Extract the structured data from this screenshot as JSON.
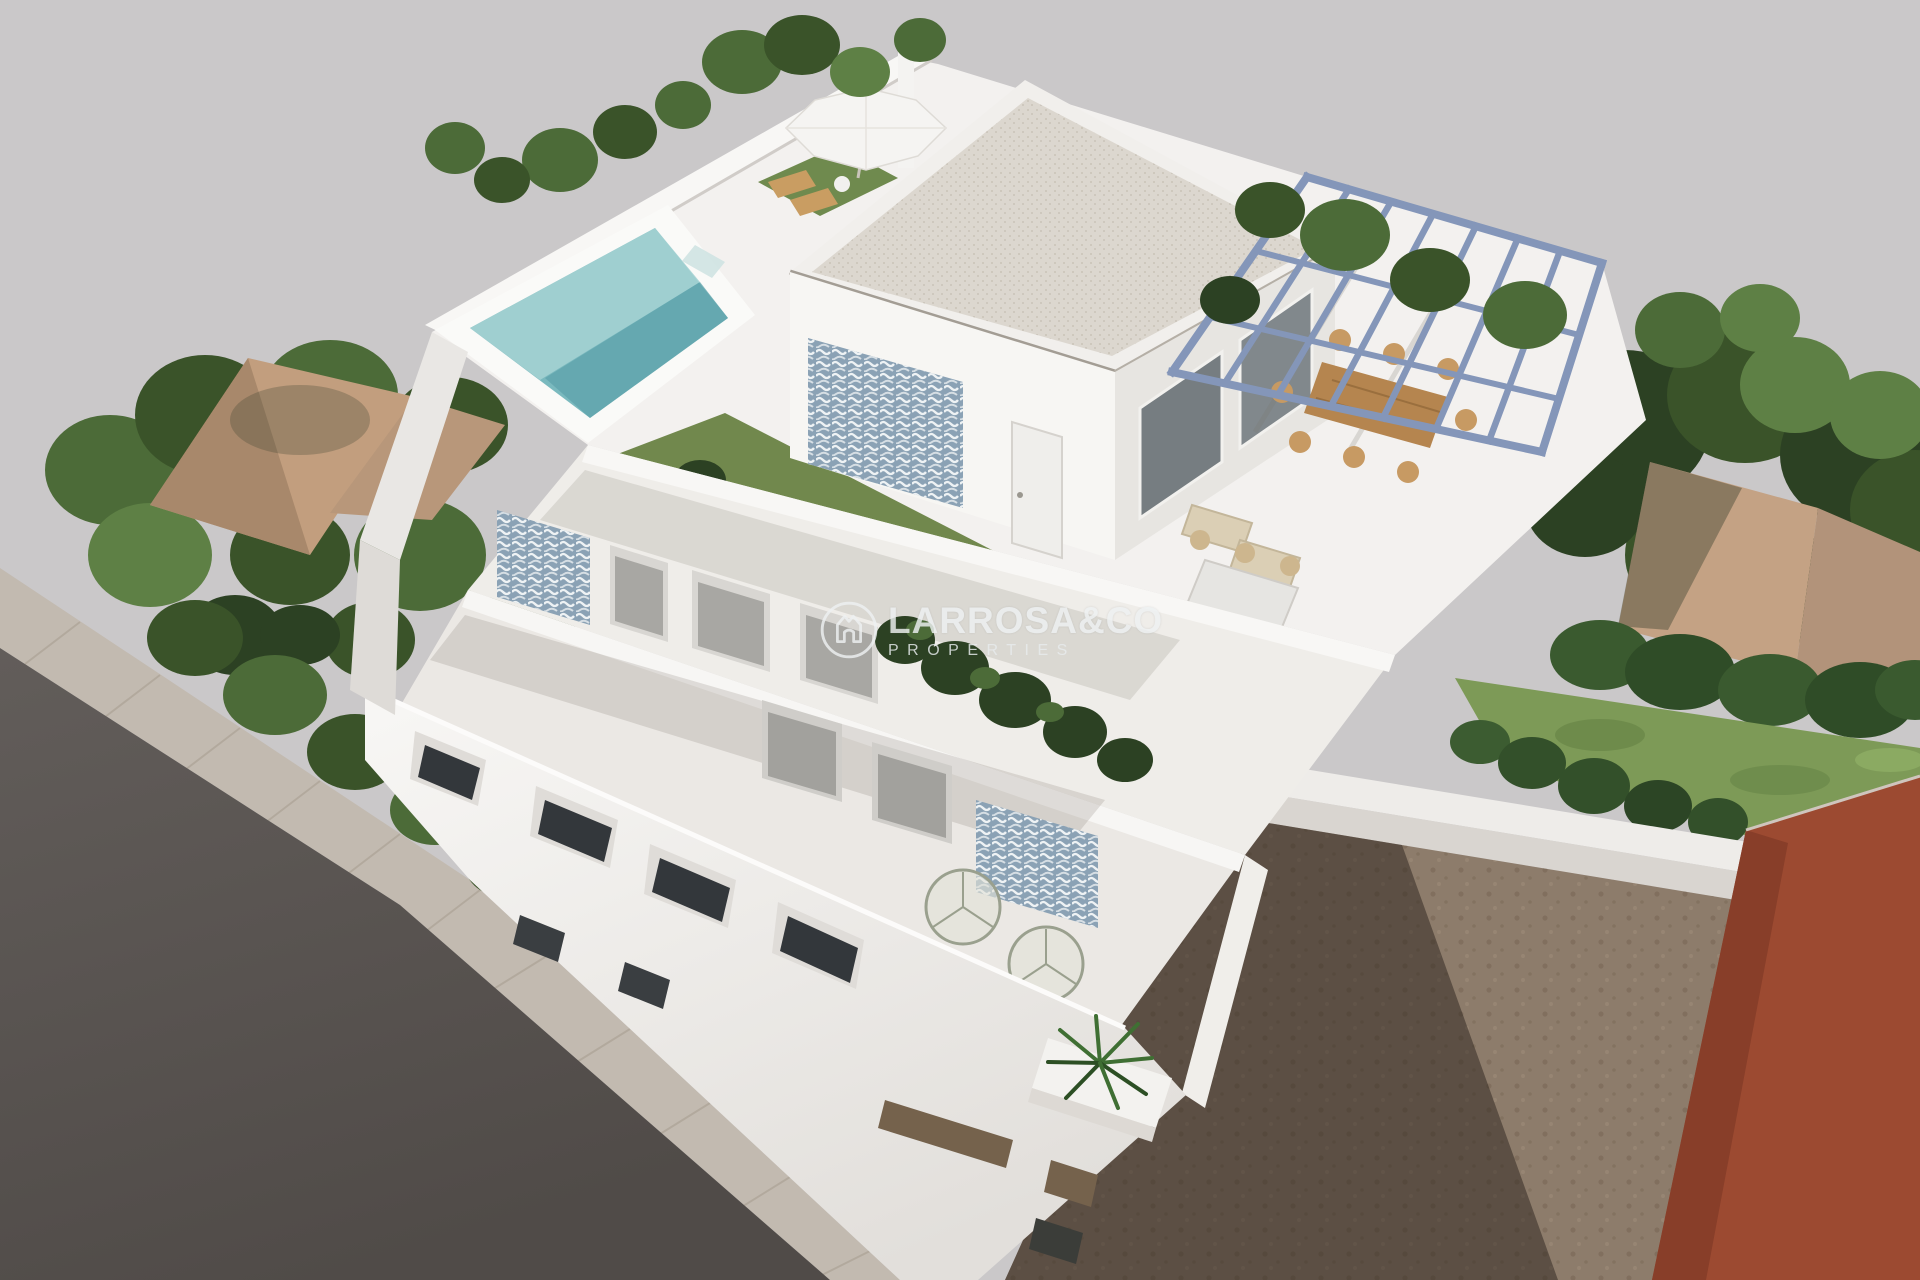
{
  "watermark": {
    "brand": "LARROSA&CO",
    "tagline": "PROPERTIES",
    "logo_icon": "house-in-circle-icon",
    "color": "#eef1f2"
  },
  "palette": {
    "background": "#cac8c9",
    "villa_white": "#f3f1ef",
    "pool_water": "#7ab9be",
    "pool_water_light": "#a6d2d3",
    "lawn": "#71884d",
    "pergola_steel": "#8496b9",
    "wood_furniture": "#b5854f",
    "terracotta_roof": "#c29e7e",
    "rust_building": "#9c4a31",
    "dirt_ground": "#8d7c6b",
    "road": "#5c5754",
    "sidewalk": "#c2bab0",
    "tile_accent": "#8ba2b5",
    "tree_green": "#3f5c33"
  }
}
